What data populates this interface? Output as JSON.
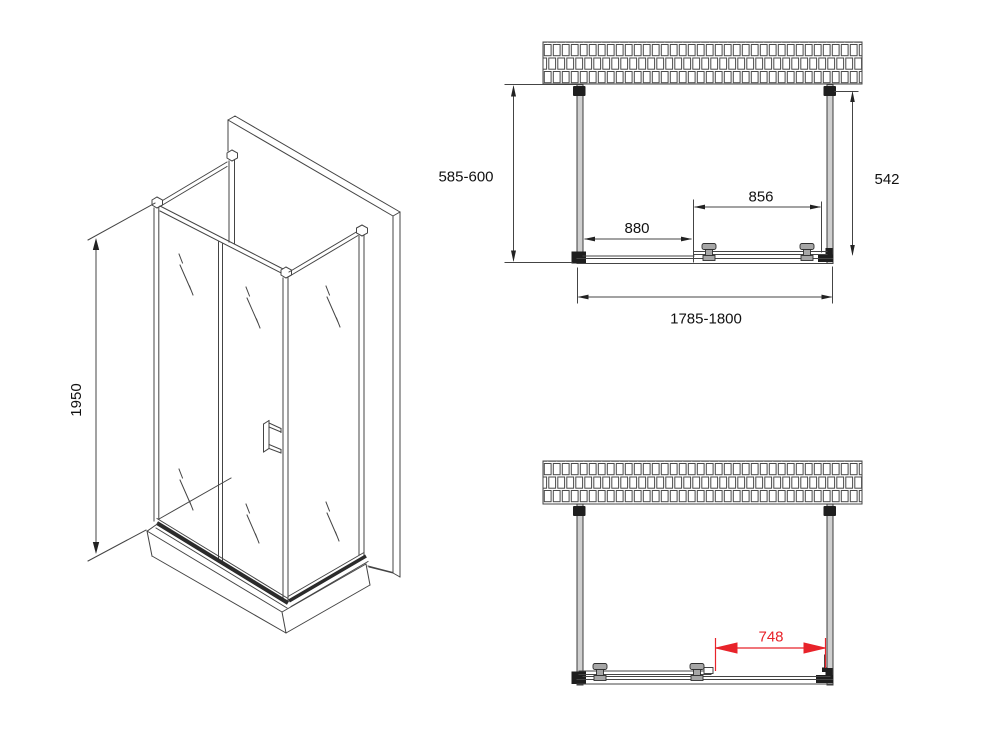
{
  "colors": {
    "line": "#444444",
    "accent_red": "#e8232a",
    "wall_fill": "#cfcfcf"
  },
  "views": {
    "isometric": {
      "height": "1950"
    },
    "plan_top": {
      "depth_left": "585-600",
      "depth_right": "542",
      "fixed_panel_width": "880",
      "door_width": "856",
      "total_width": "1785-1800"
    },
    "plan_bottom": {
      "door_opening": "748"
    }
  }
}
